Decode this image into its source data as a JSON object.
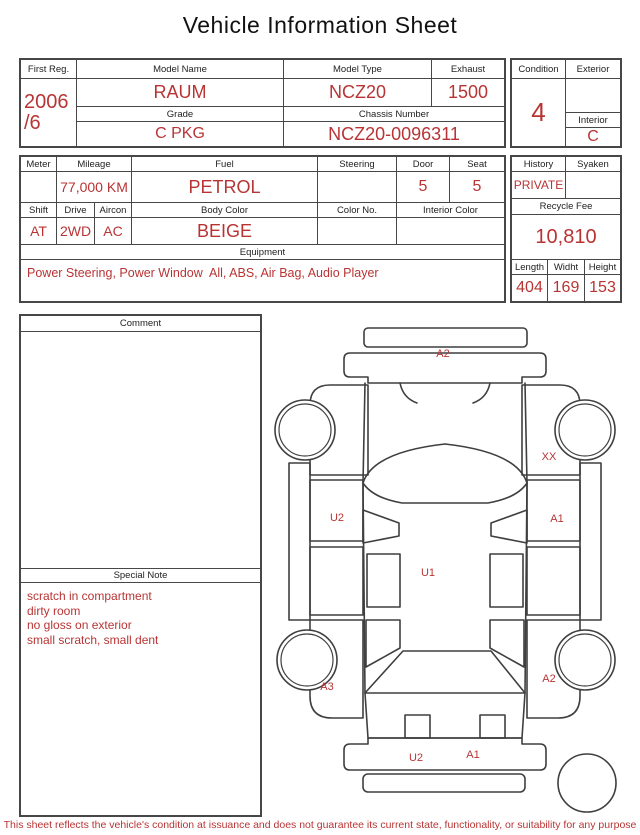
{
  "title": "Vehicle Information Sheet",
  "colors": {
    "accent_red": "#b83434",
    "border": "#474747"
  },
  "table1": {
    "first_reg_label": "First Reg.",
    "first_reg_line1": "2006",
    "first_reg_line2": "/6",
    "model_name_label": "Model Name",
    "model_name": "RAUM",
    "model_type_label": "Model Type",
    "model_type": "NCZ20",
    "exhaust_label": "Exhaust",
    "exhaust": "1500",
    "grade_label": "Grade",
    "grade": "C PKG",
    "chassis_label": "Chassis Number",
    "chassis_number": "NCZ20-0096311",
    "condition_label": "Condition",
    "condition": "4",
    "exterior_label": "Exterior",
    "exterior": "",
    "interior_label": "Interior",
    "interior": "C"
  },
  "table2": {
    "meter_label": "Meter",
    "meter": "",
    "mileage_label": "Mileage",
    "mileage": "77,000 KM",
    "fuel_label": "Fuel",
    "fuel": "PETROL",
    "steering_label": "Steering",
    "steering": "",
    "door_label": "Door",
    "door": "5",
    "seat_label": "Seat",
    "seat": "5",
    "shift_label": "Shift",
    "shift": "AT",
    "drive_label": "Drive",
    "drive": "2WD",
    "aircon_label": "Aircon",
    "aircon": "AC",
    "body_color_label": "Body Color",
    "body_color": "BEIGE",
    "color_no_label": "Color No.",
    "color_no": "",
    "interior_color_label": "Interior Color",
    "interior_color": "",
    "equipment_label": "Equipment",
    "equipment": "Power Steering, Power Window  All, ABS, Air Bag, Audio Player",
    "history_label": "History",
    "history": "PRIVATE",
    "syaken_label": "Syaken",
    "syaken": "",
    "recycle_fee_label": "Recycle Fee",
    "recycle_fee": "10,810",
    "length_label": "Length",
    "length": "404",
    "width_label": "Widht",
    "width": "169",
    "height_label": "Height",
    "height": "153"
  },
  "comment": {
    "label": "Comment",
    "text": ""
  },
  "special_note": {
    "label": "Special Note",
    "lines": [
      "scratch in compartment",
      "dirty room",
      "no gloss on exterior",
      "small scratch, small dent"
    ]
  },
  "diagram": {
    "labels": [
      {
        "code": "A2",
        "x": 173,
        "y": 42,
        "area": "front-bumper"
      },
      {
        "code": "XX",
        "x": 279,
        "y": 145,
        "area": "right-front-fender"
      },
      {
        "code": "U2",
        "x": 67,
        "y": 206,
        "area": "left-front-door"
      },
      {
        "code": "A1",
        "x": 287,
        "y": 207,
        "area": "right-front-door"
      },
      {
        "code": "U1",
        "x": 158,
        "y": 261,
        "area": "cabin-center"
      },
      {
        "code": "A3",
        "x": 57,
        "y": 375,
        "area": "left-rear-wheel"
      },
      {
        "code": "A2",
        "x": 279,
        "y": 367,
        "area": "right-rear-fender"
      },
      {
        "code": "U2",
        "x": 146,
        "y": 446,
        "area": "rear-bumper-left"
      },
      {
        "code": "A1",
        "x": 203,
        "y": 443,
        "area": "rear-bumper-right"
      }
    ]
  },
  "footer": {
    "disclaimer": "This sheet reflects the vehicle's condition at issuance and does not guarantee its current state, functionality, or suitability for any purpose"
  }
}
